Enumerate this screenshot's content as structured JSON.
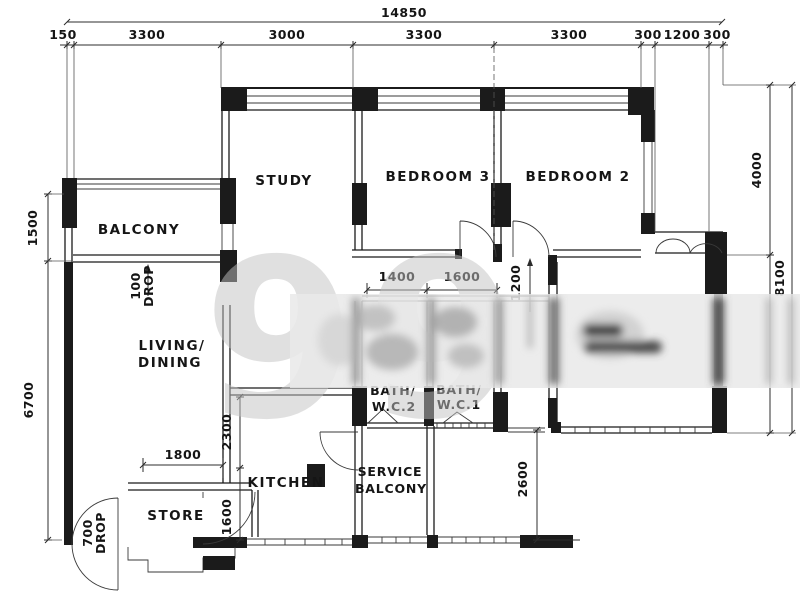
{
  "watermark": {
    "text": "99"
  },
  "rooms": {
    "balcony": "BALCONY",
    "study": "STUDY",
    "bedroom3": "BEDROOM 3",
    "bedroom2": "BEDROOM 2",
    "living_line1": "LIVING/",
    "living_line2": "DINING",
    "kitchen": "KITCHEN",
    "store": "STORE",
    "service_line1": "SERVICE",
    "service_line2": "BALCONY",
    "bath2_line1": "BATH/",
    "bath2_line2": "W.C.2",
    "bath1_line1": "BATH/",
    "bath1_line2": "W.C.1"
  },
  "dimensions": {
    "overall_width": "14850",
    "top": [
      "150",
      "3300",
      "3000",
      "3300",
      "3300",
      "300",
      "1200",
      "300"
    ],
    "left_upper": "1500",
    "left_lower": "6700",
    "right_upper": "4000",
    "right_lower": "8100",
    "bath2_width": "1400",
    "bath1_width": "1600",
    "hall_depth": "1200",
    "terrace_depth": "2600",
    "kitchen_depth": "2300",
    "kitchen_lower": "1600",
    "store_width": "1800"
  },
  "annotations": {
    "balcony_drop_line1": "100",
    "balcony_drop_line2": "DROP",
    "entrance_drop_line1": "700",
    "entrance_drop_line2": "DROP"
  }
}
